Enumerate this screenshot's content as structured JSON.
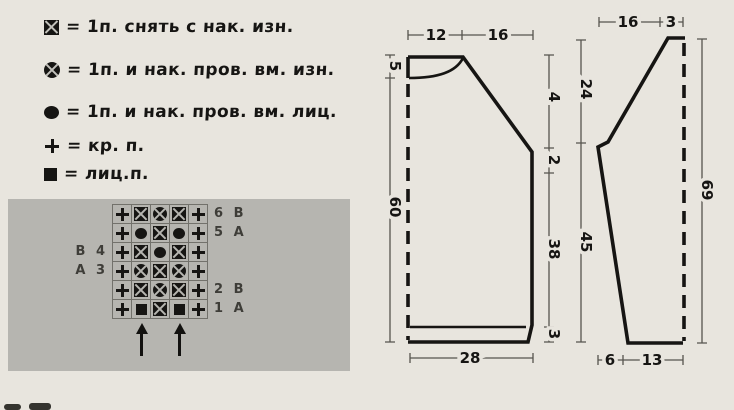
{
  "page": {
    "bg": "#e8e5de",
    "panel_bg": "#b6b5b0",
    "ink": "#161513",
    "grid_line": "#72716b"
  },
  "legend": {
    "items": [
      {
        "symbol": "square-x-icon",
        "text": "= 1п. снять с нак. изн."
      },
      {
        "symbol": "circle-x-icon",
        "text": "= 1п. и нак. пров. вм. изн."
      },
      {
        "symbol": "dot-icon",
        "text": "= 1п. и нак. пров. вм. лиц."
      },
      {
        "symbol": "plus-icon",
        "text": "= кр. п."
      },
      {
        "symbol": "square-icon",
        "text": "= лиц.п."
      }
    ]
  },
  "chart": {
    "columns": 5,
    "rows": 6,
    "row_data": [
      {
        "row": "6",
        "side": "right",
        "label": "6 В",
        "cells": [
          "plus",
          "sqx",
          "cirx",
          "sqx",
          "plus"
        ]
      },
      {
        "row": "5",
        "side": "right",
        "label": "5 А",
        "cells": [
          "plus",
          "dot",
          "sqx",
          "dot",
          "plus"
        ]
      },
      {
        "row": "4",
        "side": "left",
        "label": "В 4",
        "cells": [
          "plus",
          "sqx",
          "dot",
          "sqx",
          "plus"
        ]
      },
      {
        "row": "3",
        "side": "left",
        "label": "А 3",
        "cells": [
          "plus",
          "cirx",
          "sqx",
          "cirx",
          "plus"
        ]
      },
      {
        "row": "2",
        "side": "right",
        "label": "2 В",
        "cells": [
          "plus",
          "sqx",
          "cirx",
          "sqx",
          "plus"
        ]
      },
      {
        "row": "1",
        "side": "right",
        "label": "1 А",
        "cells": [
          "plus",
          "sq",
          "sqx",
          "sq",
          "plus"
        ]
      }
    ],
    "arrow_columns": [
      2,
      4
    ]
  },
  "schematics": {
    "body": {
      "top": [
        "12",
        "16"
      ],
      "left": [
        "5",
        "60"
      ],
      "right": [
        "4",
        "2",
        "38",
        "3"
      ],
      "bottom": [
        "28"
      ]
    },
    "sleeve": {
      "top": [
        "16",
        "3"
      ],
      "left": [
        "24",
        "45"
      ],
      "right": [
        "69"
      ],
      "bottom": [
        "6",
        "13"
      ]
    }
  }
}
